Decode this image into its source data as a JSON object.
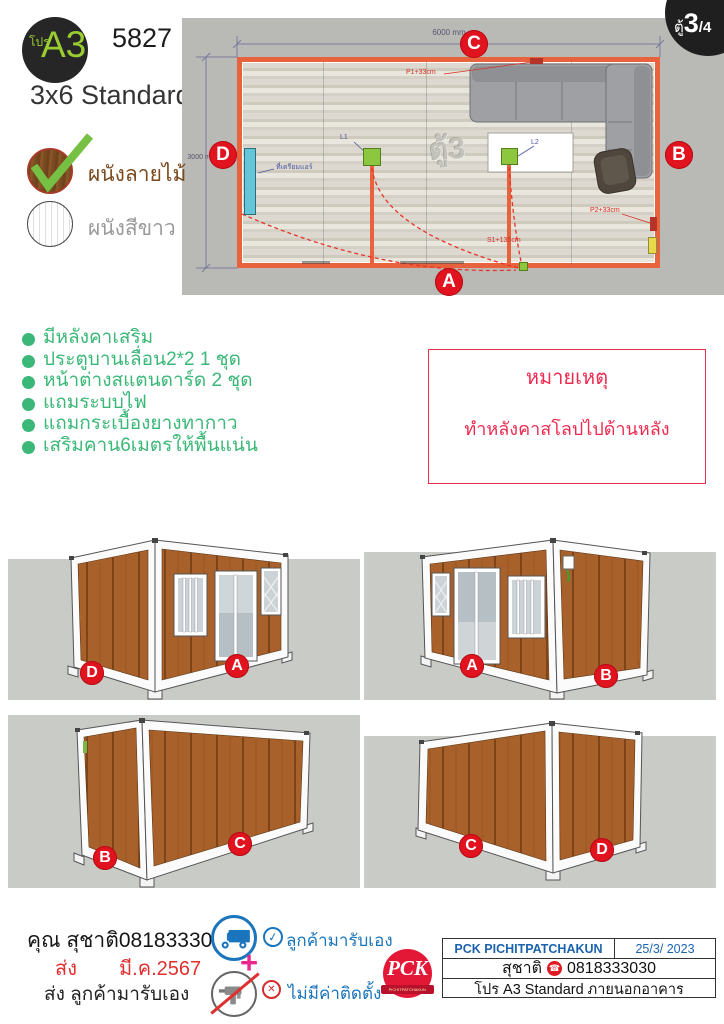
{
  "header": {
    "badge": {
      "small": "โปร",
      "big": "A3"
    },
    "code": "5827",
    "model": "3x6 Standard",
    "unit": {
      "prefix": "ตู้",
      "num": "3",
      "den": "/4"
    }
  },
  "options": [
    {
      "label": "ผนังลายไม้",
      "selected": true
    },
    {
      "label": "ผนังสีขาว",
      "selected": false
    }
  ],
  "features": {
    "items": [
      "มีหลังคาเสริม",
      "ประตูบานเลื่อน2*2 1 ชุด",
      "หน้าต่างสแตนดาร์ด 2 ชุด",
      "แถมระบบไฟ",
      "แถมกระเบื้องยางทากาว",
      "เสริมคาน6เมตรให้พื้นแน่น"
    ]
  },
  "note": {
    "title": "หมายเหตุ",
    "body": "ทำหลังคาสโลปไปด้านหลัง"
  },
  "plan": {
    "dims": {
      "width": "6000 mm",
      "height": "3000 mm"
    },
    "watermark": "ตู้3",
    "sides": {
      "top": "C",
      "right": "B",
      "bottom": "A",
      "left": "D"
    },
    "annotations": {
      "l1": "L1",
      "l2": "L2",
      "p1": "P1+33cm",
      "p2": "P2+33cm",
      "s1": "S1+135cm",
      "wall_item": "ที่เตรียมแอร์"
    }
  },
  "views": [
    {
      "labels": [
        "D",
        "A"
      ]
    },
    {
      "labels": [
        "A",
        "B"
      ]
    },
    {
      "labels": [
        "B",
        "C"
      ]
    },
    {
      "labels": [
        "C",
        "D"
      ]
    }
  ],
  "footer": {
    "customer": "คุณ สุชาติ0818333030",
    "ship_label": "ส่ง",
    "ship_date": "มี.ค.2567",
    "delivery": "ส่ง ลูกค้ามารับเอง",
    "pickup": "ลูกค้ามารับเอง",
    "no_install": "ไม่มีค่าติดตั้ง",
    "plus": "+",
    "table": {
      "company": "PCK PICHITPATCHAKUN",
      "date": "25/3/ 2023",
      "name": "สุชาติ",
      "phone": "0818333030",
      "desc": "โปร A3 Standard ภายนอกอาคาร"
    },
    "logo": {
      "text": "PCK",
      "sub": "PICHITPATCHAKUN"
    }
  },
  "colors": {
    "accent_green": "#3bb878",
    "badge_red": "#e0131e",
    "note_red": "#ed2b50",
    "wall_orange": "#e8623d",
    "blue": "#1b75bc",
    "wood": "#a9612b",
    "magenta": "#ec268f"
  }
}
